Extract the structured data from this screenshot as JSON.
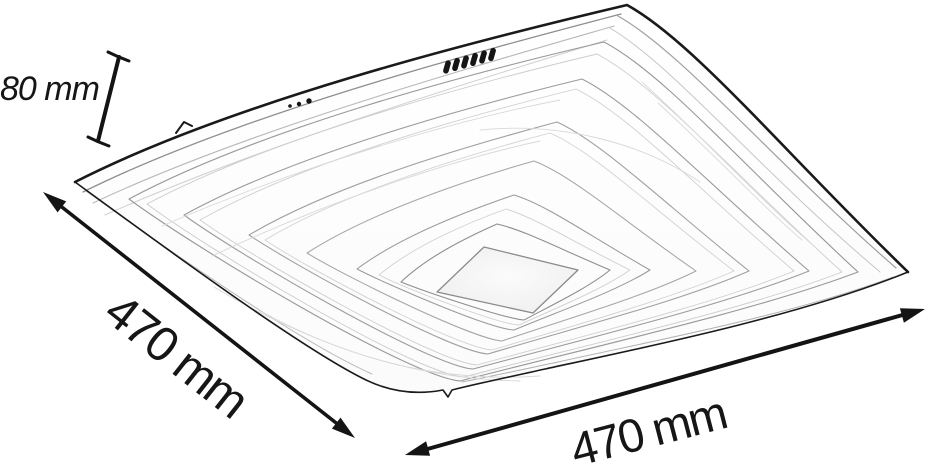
{
  "diagram": {
    "kind": "product-dimension-diagram",
    "subject": "wavy square LED ceiling light shown in perspective line art",
    "background": "#ffffff",
    "outline_color": "#1a1a1a",
    "detail_line_color": "#b0b0b0",
    "annotation_color": "#161616",
    "annotations": [
      {
        "id": "height",
        "label": "80 mm",
        "style": "dimension-line-with-end-ticks"
      },
      {
        "id": "width-left",
        "label": "470 mm",
        "style": "double-headed-arrow-diagonal"
      },
      {
        "id": "width-bottom",
        "label": "470 mm",
        "style": "double-headed-arrow-bottom"
      }
    ],
    "features": {
      "connector_pins_count": 6,
      "mounting_dots_count": 3
    }
  }
}
